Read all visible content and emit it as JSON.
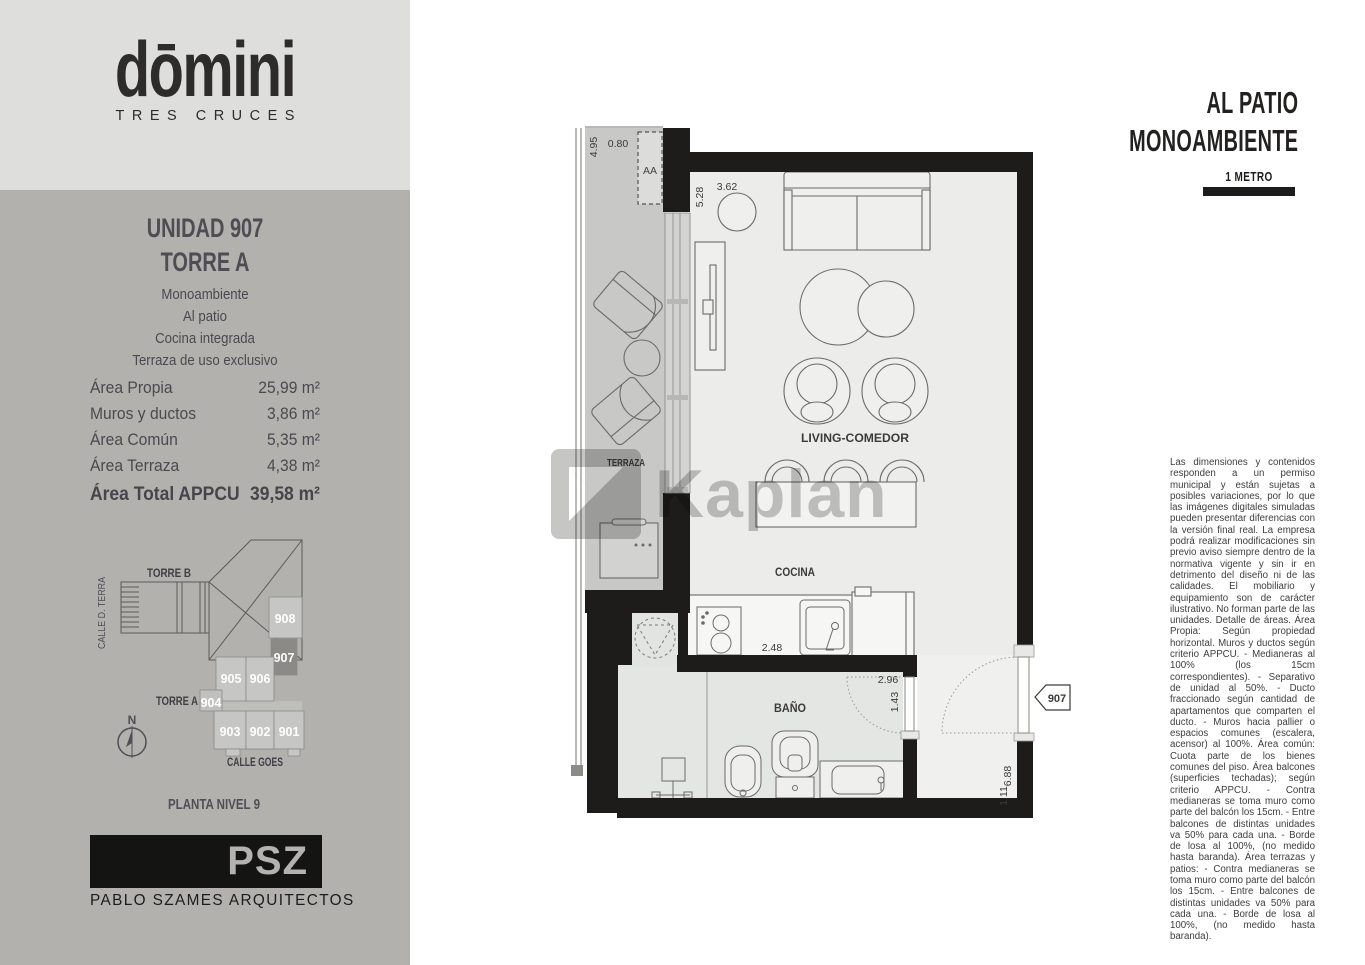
{
  "sidebar": {
    "logo": {
      "brand": "dōmini",
      "subtitle": "TRES CRUCES"
    },
    "unit": {
      "title": "UNIDAD 907",
      "tower": "TORRE A",
      "features": [
        "Monoambiente",
        "Al patio",
        "Cocina integrada",
        "Terraza de uso exclusivo"
      ]
    },
    "areas": {
      "rows": [
        {
          "label": "Área Propia",
          "value": "25,99 m²"
        },
        {
          "label": "Muros y ductos",
          "value": "3,86 m²"
        },
        {
          "label": "Área Común",
          "value": "5,35 m²"
        },
        {
          "label": "Área Terraza",
          "value": "4,38 m²"
        }
      ],
      "total": {
        "label": "Área Total APPCU",
        "value": "39,58 m²"
      }
    },
    "siteplan": {
      "torre_b": "TORRE B",
      "torre_a": "TORRE A",
      "street_left": "CALLE D. TERRA",
      "street_bottom": "CALLE GOES",
      "compass": "N",
      "units": [
        "908",
        "907",
        "905",
        "906",
        "904",
        "903",
        "902",
        "901"
      ],
      "highlighted_unit": "907",
      "caption": "PLANTA NIVEL 9"
    },
    "studio": {
      "logo": "PSZ",
      "name": "PABLO SZAMES ARQUITECTOS"
    }
  },
  "plan": {
    "rooms": {
      "terraza": "TERRAZA",
      "living": "LIVING-COMEDOR",
      "cocina": "COCINA",
      "bano": "BAÑO"
    },
    "labels": {
      "ac_unit": "AA",
      "unit_tag": "907"
    },
    "dims": {
      "terraza_h": "4.95",
      "terraza_w": "0.80",
      "living_h": "5.28",
      "living_w": "3.62",
      "cocina_w": "2.48",
      "bano_w": "2.96",
      "bano_h": "1.43",
      "entry_h": "6.88",
      "entry_w": "1.11"
    }
  },
  "header": {
    "line1": "AL PATIO",
    "line2": "MONOAMBIENTE",
    "scale_label": "1 METRO"
  },
  "legal": {
    "text": "Las dimensiones y contenidos responden a un permiso municipal y están sujetas a posibles variaciones, por lo que las imágenes digitales simuladas pueden presentar diferencias con la versión final real. La empresa podrá realizar modificaciones sin previo aviso siempre dentro de la normativa vigente y sin ir en detrimento del diseño ni de las calidades. El mobiliario y equipamiento son de carácter ilustrativo. No forman parte de las unidades. Detalle de áreas. Área Propia: Según propiedad horizontal. Muros y ductos según criterio APPCU. - Medianeras al 100% (los 15cm correspondientes). - Separativo de unidad al 50%. - Ducto fraccionado según cantidad de apartamentos que comparten el ducto. - Muros hacia pallier o espacios comunes (escalera, acensor) al 100%. Área común: Cuota parte de los bienes comunes del piso. Área balcones (superficies techadas); según criterio APPCU. - Contra medianeras se toma muro como parte del balcón los 15cm. - Entre balcones de distintas unidades va  50% para cada una. - Borde de losa al 100%, (no medido hasta baranda). Área terrazas y patios: - Contra medianeras se toma muro como parte del balcón los 15cm. - Entre balcones de distintas unidades va  50% para cada una. - Borde de losa al 100%, (no medido hasta baranda)."
  },
  "watermark": {
    "text": "Kaplan"
  },
  "colors": {
    "wall": "#1d1c1a",
    "unit_highlight": "#8b8a86",
    "sidebar_top": "#dededc",
    "sidebar": "#b2b1ae"
  }
}
